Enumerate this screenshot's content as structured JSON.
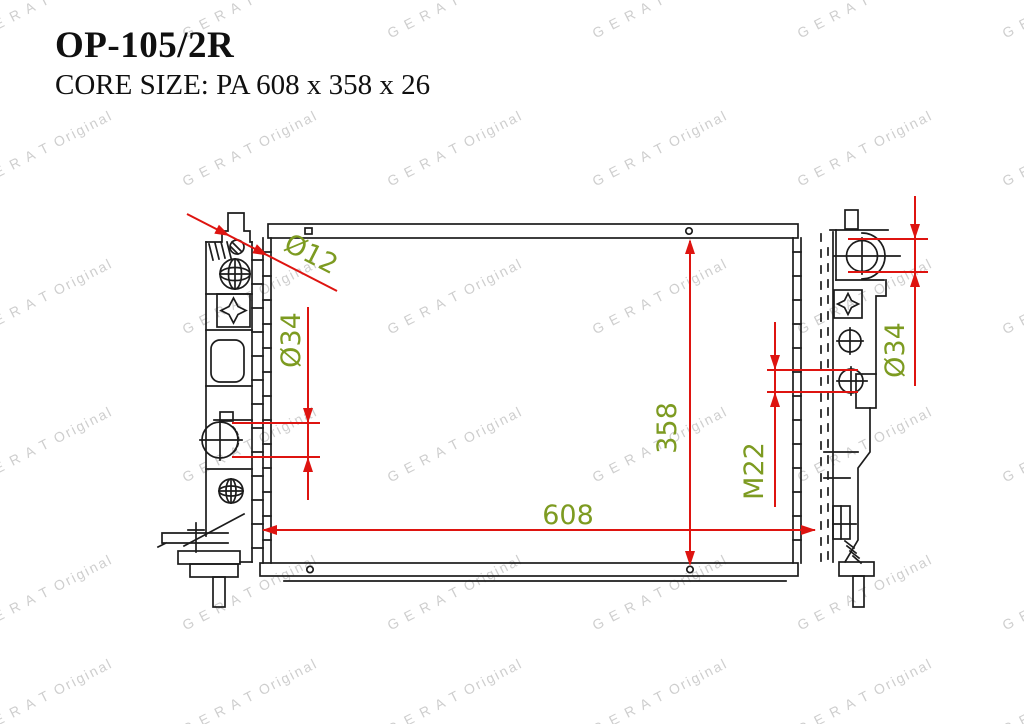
{
  "header": {
    "part_number": "OP-105/2R",
    "core_size_label": "CORE SIZE: PA 608 x 358 x 26"
  },
  "watermark": {
    "text": "G E R A T Original",
    "color": "#c6c6c6"
  },
  "diagram": {
    "subject": "radiator-front-view-technical-drawing",
    "line_color": "#1c1c1c",
    "dimension_color": "#de1410",
    "label_color": "#7d9b21",
    "dimensions": {
      "filler_hole": "Ø12",
      "left_port": "Ø34",
      "right_port": "Ø34",
      "core_height": "358",
      "core_width": "608",
      "thread": "M22"
    }
  }
}
